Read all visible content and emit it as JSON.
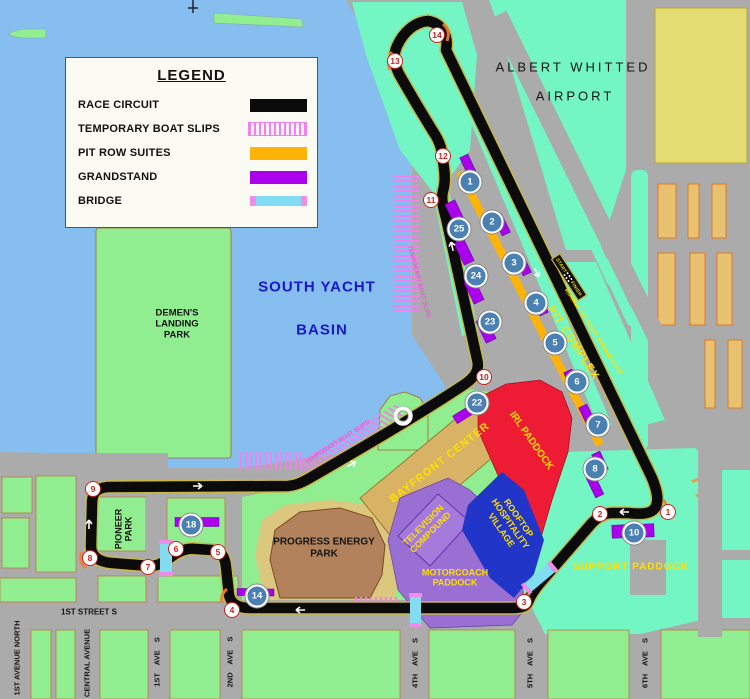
{
  "legend": {
    "title": "LEGEND",
    "items": [
      {
        "label": "RACE CIRCUIT"
      },
      {
        "label": "TEMPORARY BOAT SLIPS"
      },
      {
        "label": "PIT ROW SUITES"
      },
      {
        "label": "GRANDSTAND"
      },
      {
        "label": "BRIDGE"
      }
    ]
  },
  "areas": {
    "airport": {
      "l1": "ALBERT  WHITTED",
      "l2": "AIRPORT"
    },
    "basin": {
      "l1": "SOUTH YACHT",
      "l2": "BASIN"
    },
    "demens": {
      "l1": "DEMEN'S",
      "l2": "LANDING",
      "l3": "PARK"
    },
    "pioneer": {
      "l1": "PIONEER",
      "l2": "PARK"
    },
    "progress": {
      "l1": "PROGRESS ENERGY",
      "l2": "PARK"
    },
    "bayfront": "BAYFRONT CENTER",
    "irl": "IRL PADDOCK",
    "rooftop": {
      "l1": "ROOFTOP",
      "l2": "HOSPITALITY",
      "l3": "VILLAGE"
    },
    "tv": {
      "l1": "TELEVISION",
      "l2": "COMPOUND"
    },
    "motorcoach": {
      "l1": "MOTORCOACH",
      "l2": "PADDOCK"
    },
    "support": "SUPPORT PADDOCK",
    "pit_complex": "PIT COMPLEX",
    "runway": "RUNWAY 7/25 FRONT STRAIGHTAWAY",
    "boat_slips": "TEMPORARY BOAT SLIPS"
  },
  "start_finish": {
    "start": "START",
    "finish": "FINISH"
  },
  "streets": {
    "first_street": "1ST STREET S",
    "vertical": [
      "1ST AVENUE NORTH",
      "CENTRAL AVENUE",
      "1ST AVE S",
      "2ND AVE S",
      "4TH AVE S",
      "5TH AVE S",
      "6TH AVE S"
    ]
  },
  "track": {
    "turns": [
      "1",
      "2",
      "3",
      "4",
      "5",
      "6",
      "7",
      "8",
      "9",
      "10",
      "11",
      "12",
      "13",
      "14"
    ],
    "grandstands": [
      "1",
      "2",
      "3",
      "4",
      "5",
      "6",
      "7",
      "8",
      "10",
      "14",
      "18",
      "22",
      "23",
      "24",
      "25"
    ]
  },
  "colors": {
    "water": "#85BEEF",
    "park_green": "#90EE90",
    "airport_green": "#73F6C4",
    "road_gray": "#ABABAB",
    "track_black": "#0B0B0B",
    "track_edge": "#C8B840",
    "grandstand_purple": "#AA00EE",
    "pit_orange": "#FFB405",
    "boat_slip_pink": "#EE82EE",
    "bridge_cyan": "#82DCF2",
    "bridge_cap_pink": "#F08CE8",
    "irl_red": "#ED1B34",
    "rooftop_blue": "#2136C8",
    "compound_lilac": "#9A6FD4",
    "bayfront_tan": "#D8B365",
    "progress_brown": "#B2825C",
    "progress_ring": "#DCC77E",
    "khaki_block": "#E3DC72",
    "tan_building": "#E8C270",
    "label_yellow": "#FFDF00",
    "turn_red": "#CC2020",
    "grandstand_blue": "#4A80B2"
  }
}
